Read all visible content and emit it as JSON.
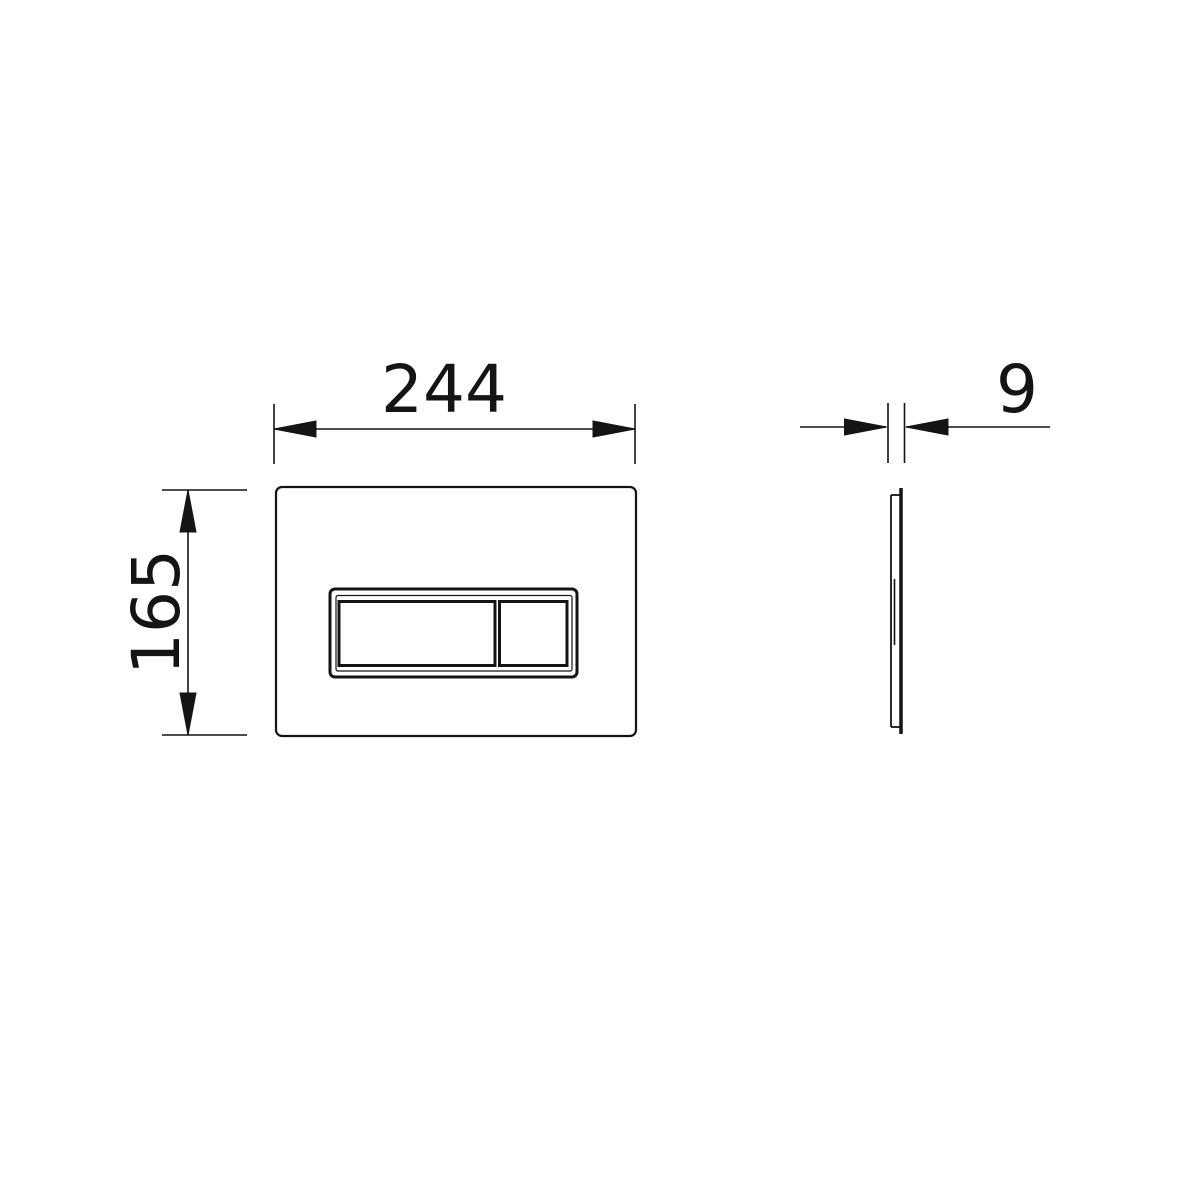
{
  "page": {
    "background_color": "#ffffff"
  },
  "drawing": {
    "line_color": "#141414",
    "front_view": {
      "width_label": "244",
      "height_label": "165"
    },
    "side_view": {
      "thickness_label": "9"
    }
  }
}
